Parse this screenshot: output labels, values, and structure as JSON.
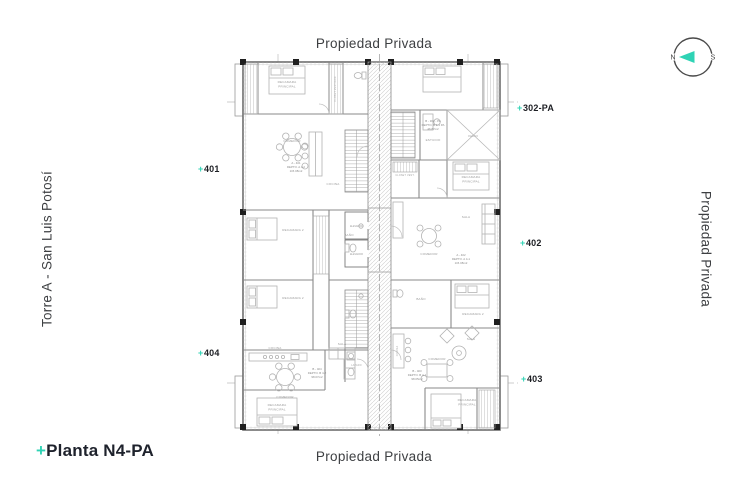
{
  "accent": "#2fd3b5",
  "labels": {
    "top": "Propiedad Privada",
    "bottom": "Propiedad Privada",
    "right": "Propiedad Privada",
    "left": "Torre A - San Luis Potosí"
  },
  "title": {
    "plus": "+",
    "name": "Planta N4-PA"
  },
  "compass": {
    "n": "N",
    "s": "S"
  },
  "units": [
    {
      "plus": "+",
      "num": "302-PA"
    },
    {
      "plus": "+",
      "num": "401"
    },
    {
      "plus": "+",
      "num": "402"
    },
    {
      "plus": "+",
      "num": "403"
    },
    {
      "plus": "+",
      "num": "404"
    }
  ],
  "plan": {
    "elevator_label": "ELEVADOR",
    "rooms": [
      {
        "l1": "RECAMARA",
        "l2": "PRINCIPAL"
      },
      {
        "l1": "CLOSET VESTIDOR"
      },
      {
        "l1": "COMEDOR"
      },
      {
        "l1": "COCINA"
      },
      {
        "l1": "RECAMARA 2"
      },
      {
        "l1": "RECAMARA 2"
      },
      {
        "l1": "BAÑO"
      },
      {
        "l1": "ESTUDIO"
      },
      {
        "l1": "VACIO"
      },
      {
        "l1": "RECAMARA",
        "l2": "PRINCIPAL"
      },
      {
        "l1": "CLOSET VEST."
      },
      {
        "l1": "SALA"
      },
      {
        "l1": "COMEDOR"
      },
      {
        "l1": "RECAMARA 2"
      },
      {
        "l1": "BAÑO"
      },
      {
        "l1": "COCINA"
      },
      {
        "l1": "SALA"
      },
      {
        "l1": "COMEDOR"
      },
      {
        "l1": "RECAMARA",
        "l2": "PRINCIPAL"
      },
      {
        "l1": "COCINA"
      },
      {
        "l1": "COMEDOR"
      },
      {
        "l1": "SALA"
      },
      {
        "l1": "RECAMARA",
        "l2": "PRINCIPAL"
      },
      {
        "l1": "LAVADO"
      }
    ],
    "deptos": [
      {
        "l1": "B - 302 - PA",
        "l2": "DEPTO. B 3-1 PA",
        "l3": "46.87m2"
      },
      {
        "l1": "A - 401",
        "l2": "DEPTO. A 4-2",
        "l3": "115.08m2"
      },
      {
        "l1": "A - 402",
        "l2": "DEPTO. A 4-1",
        "l3": "115.08m2"
      },
      {
        "l1": "B - 403",
        "l2": "DEPTO. B 4-1",
        "l3": "98.05m2"
      },
      {
        "l1": "B - 404",
        "l2": "DEPTO. B 4-2",
        "l3": "98.07m2"
      }
    ]
  }
}
